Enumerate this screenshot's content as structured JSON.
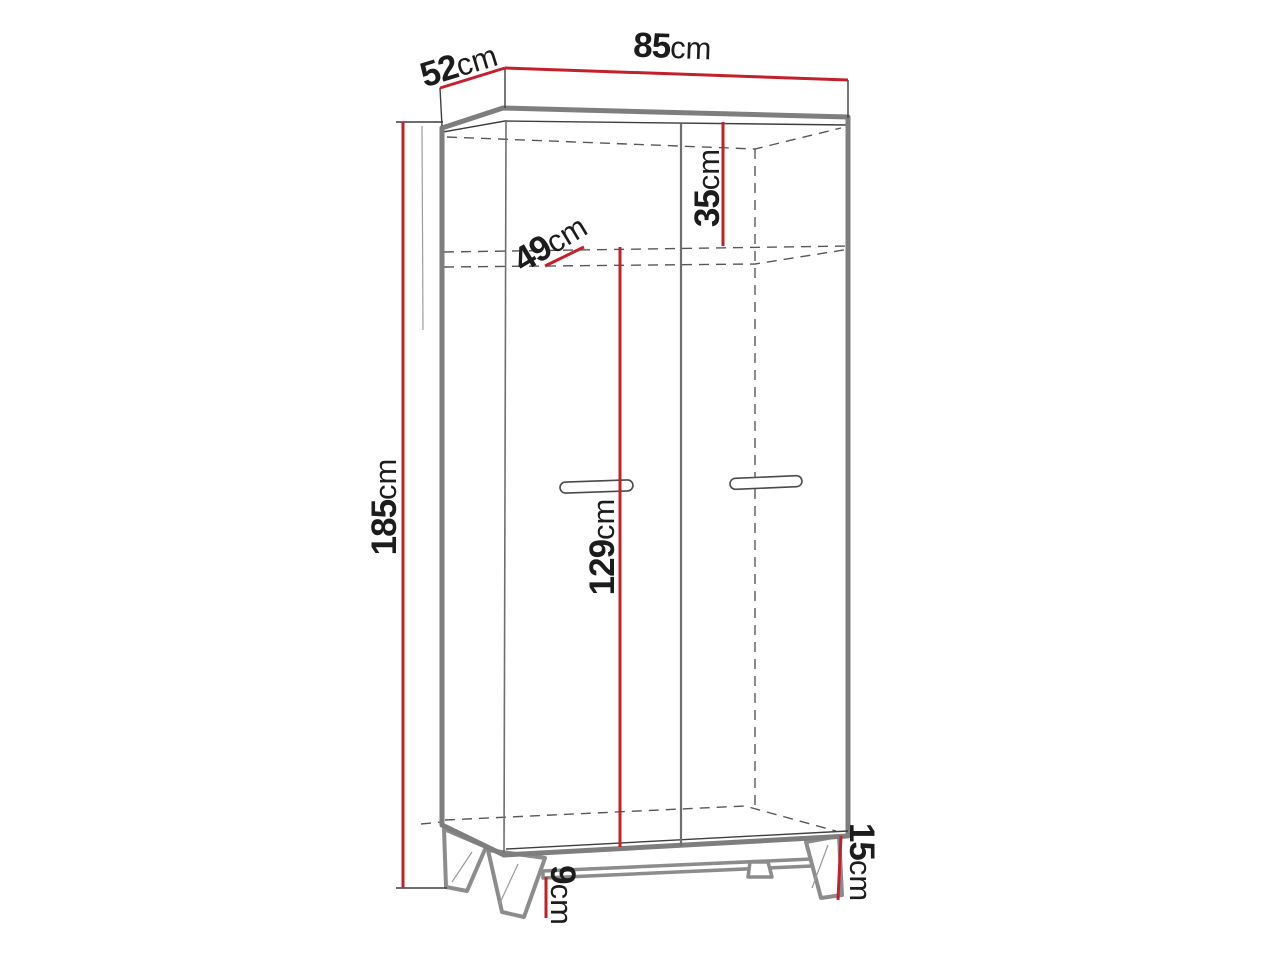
{
  "colors": {
    "page_bg": "#ffffff",
    "dimension_red": "#c2202a",
    "outline_gray": "#7e7e7e",
    "leg_gray": "#8c8c8c",
    "line_dark": "#3e3e3e",
    "dash_gray": "#575757",
    "text_dark": "#1c1c1c"
  },
  "diagram": {
    "dimensions": {
      "depth": {
        "value": "52",
        "unit": "cm"
      },
      "width": {
        "value": "85",
        "unit": "cm"
      },
      "height": {
        "value": "185",
        "unit": "cm"
      },
      "top_compartment": {
        "value": "35",
        "unit": "cm"
      },
      "shelf_depth": {
        "value": "49",
        "unit": "cm"
      },
      "door_section": {
        "value": "129",
        "unit": "cm"
      },
      "floor_clearance": {
        "value": "9",
        "unit": "cm"
      },
      "leg_height": {
        "value": "15",
        "unit": "cm"
      }
    }
  }
}
